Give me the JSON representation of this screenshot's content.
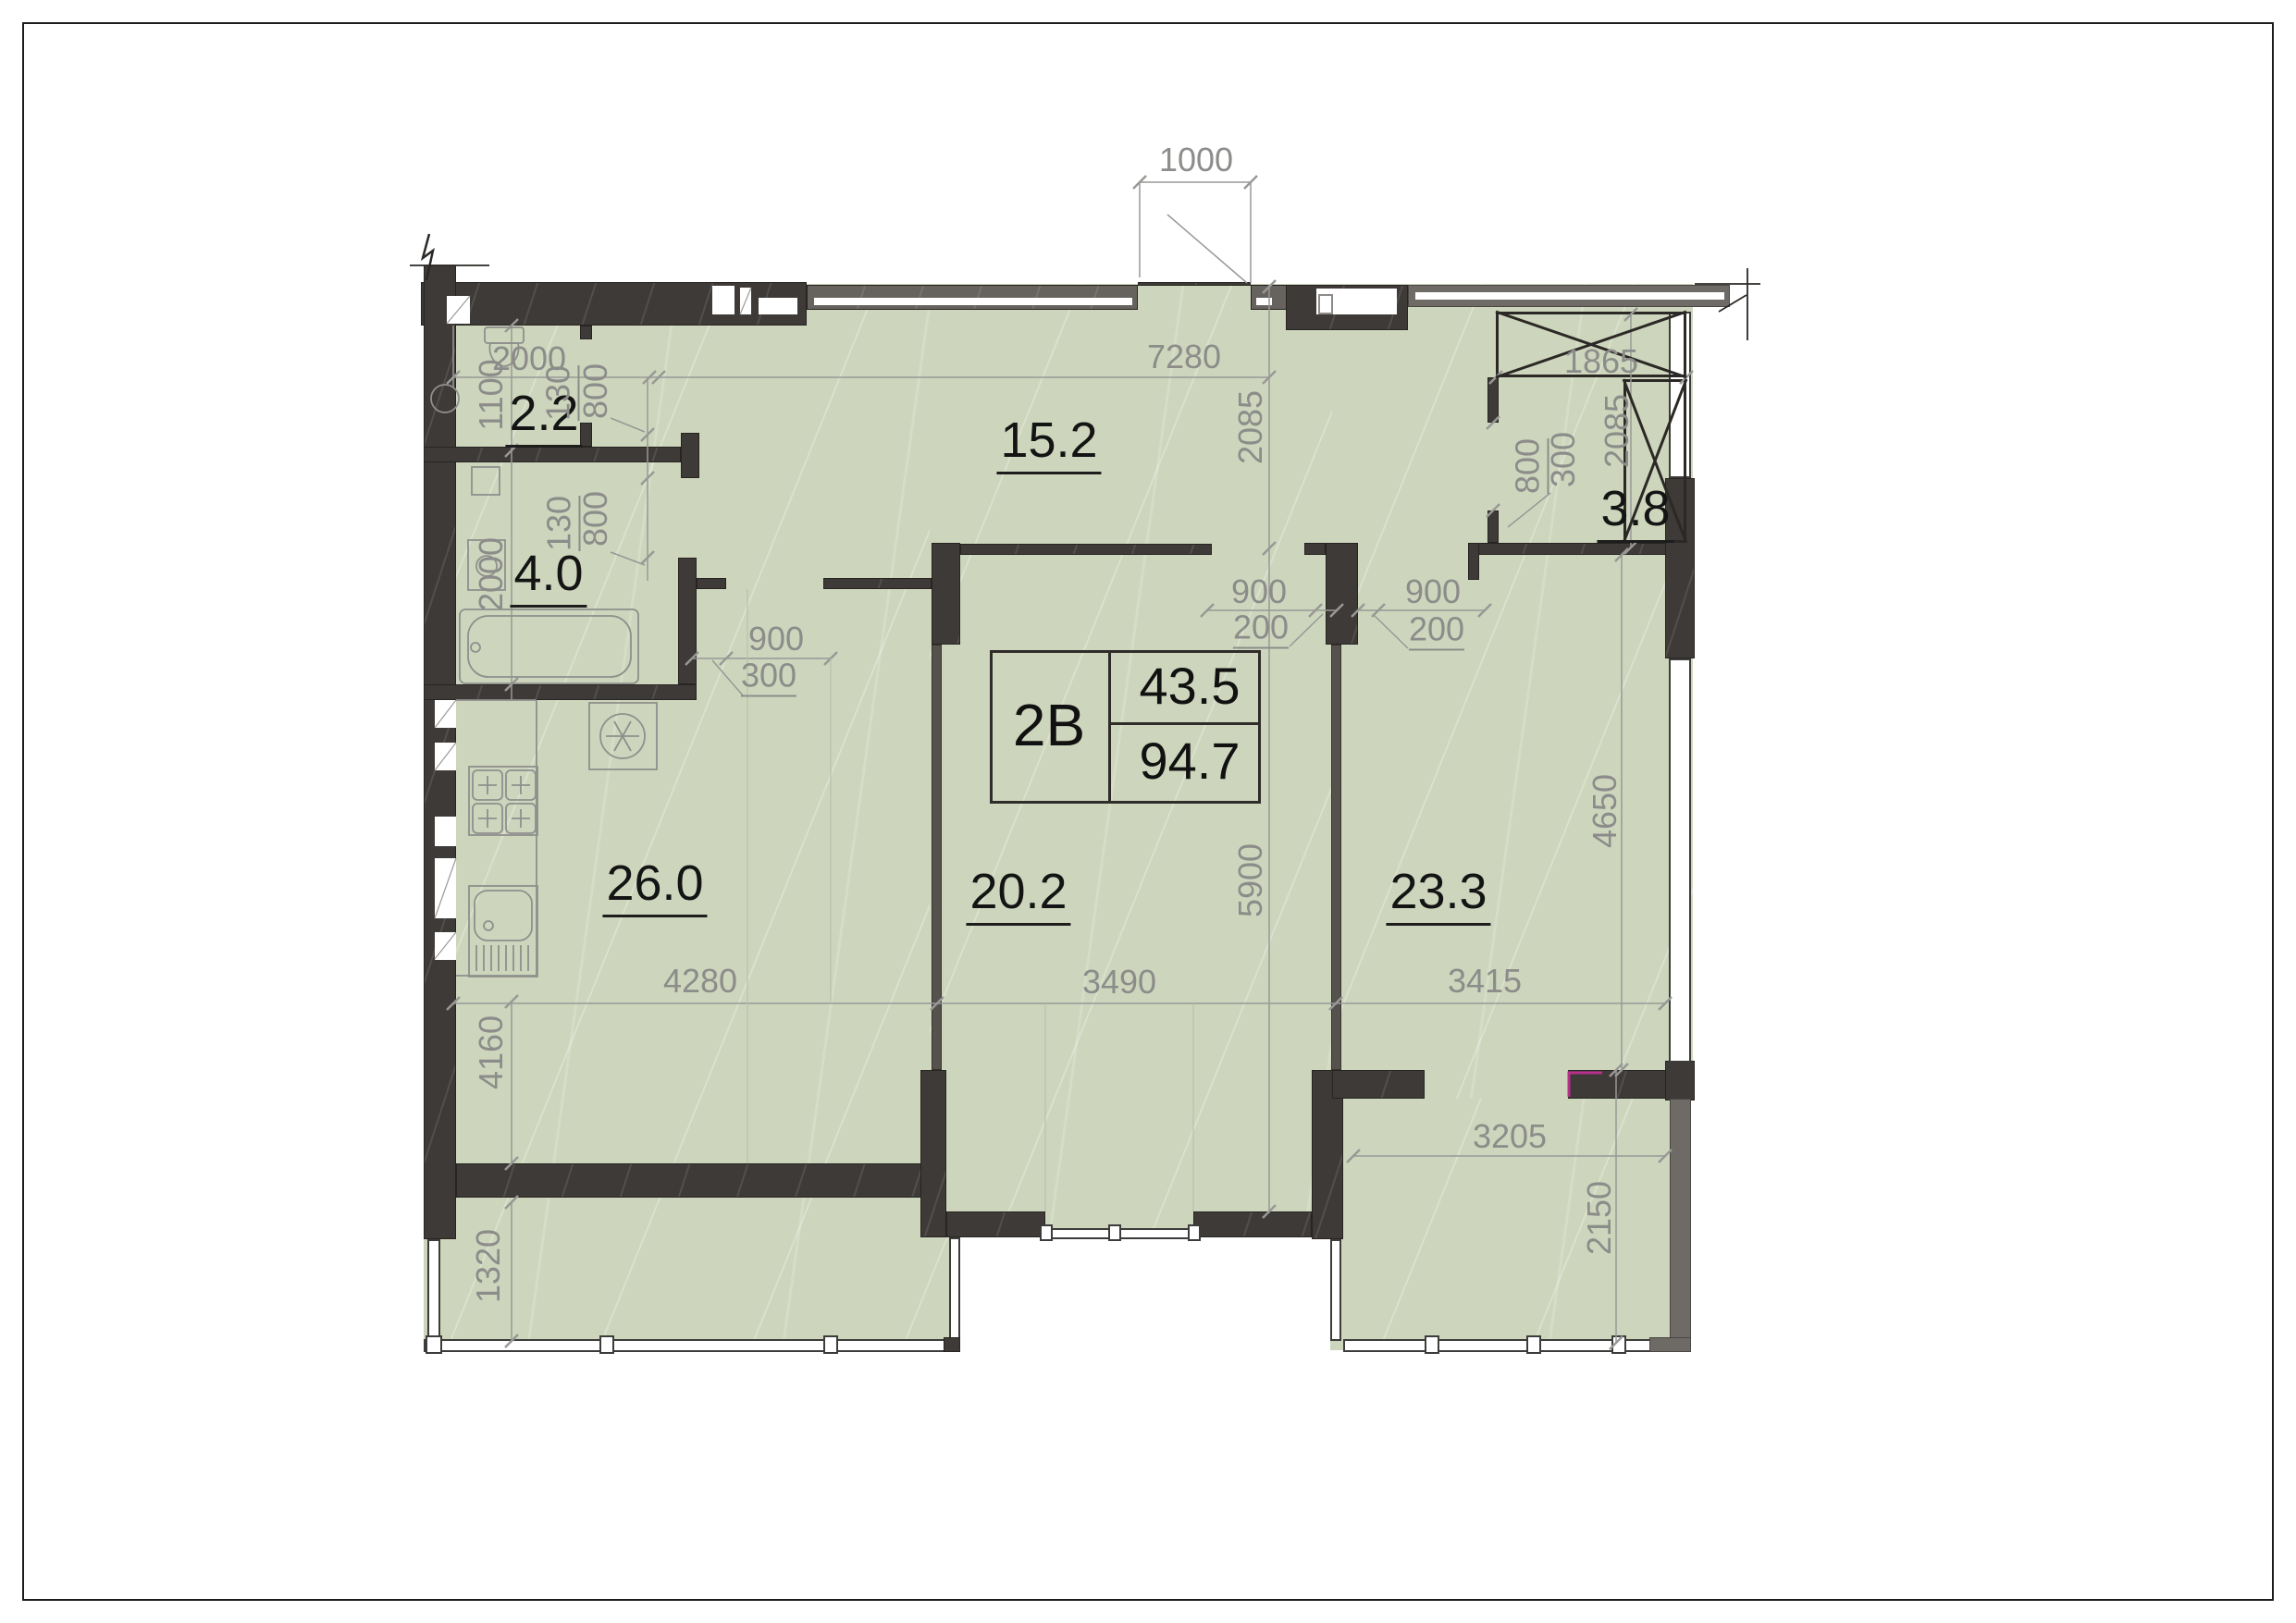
{
  "plan": {
    "unit_code": "2B",
    "living_area": "43.5",
    "total_area": "94.7"
  },
  "rooms": [
    {
      "name": "wc",
      "area": "2.2"
    },
    {
      "name": "bathroom",
      "area": "4.0"
    },
    {
      "name": "hallway",
      "area": "15.2"
    },
    {
      "name": "storage",
      "area": "3.8"
    },
    {
      "name": "kitchen-living-room",
      "area": "26.0"
    },
    {
      "name": "room-center",
      "area": "20.2"
    },
    {
      "name": "room-right",
      "area": "23.3"
    }
  ],
  "dimensions": {
    "top_opening": "1000",
    "wc_width": "2000",
    "hall_width": "7280",
    "wc_height": "1100",
    "wc_door_jamb": "130",
    "wc_door": "800",
    "bath_door_jamb": "130",
    "bath_door": "800",
    "bath_height": "2000",
    "hall_depth": "2085",
    "shaft_width": "1865",
    "storage_door": "800",
    "storage_door_jamb": "300",
    "storage_depth": "2085",
    "kitchen_door": "900",
    "kitchen_door_jamb": "300",
    "room_center_door": "900",
    "room_center_door_jamb": "200",
    "room_right_door": "900",
    "room_right_door_jamb": "200",
    "kitchen_width": "4280",
    "room_center_width": "3490",
    "room_right_width": "3415",
    "room_center_height": "5900",
    "room_right_height": "4650",
    "kitchen_lower_height": "4160",
    "balcony_left_depth": "1320",
    "balcony_right_width": "3205",
    "balcony_right_depth": "2150"
  },
  "colors": {
    "room_fill": "#cdd6bc",
    "wall_dark": "#3e3a37",
    "wall_light": "#6e6a66",
    "dimension_text": "#8c8c8a",
    "label_text": "#141414",
    "accent_mark": "#b82f8e"
  }
}
